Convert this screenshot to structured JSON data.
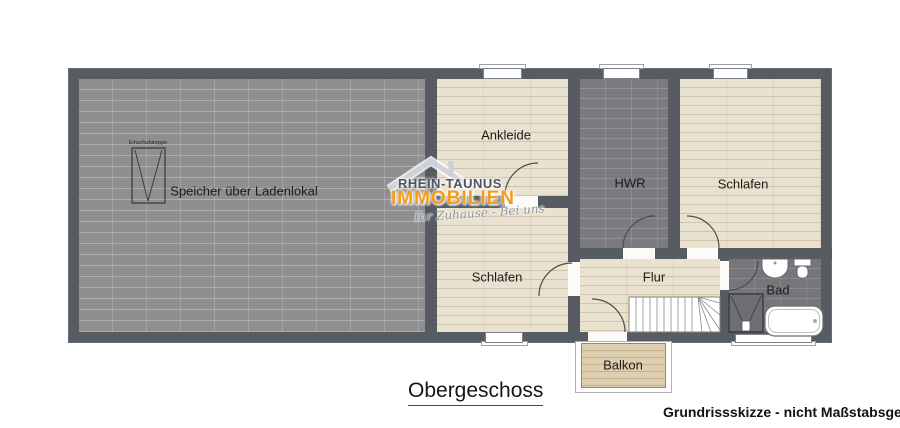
{
  "title": {
    "floor": "Obergeschoss",
    "disclaimer": "Grundrissskizze - nicht Maßstabsgetreu!"
  },
  "logo": {
    "name_top": "RHEIN-TAUNUS",
    "name_bottom": "IMMOBILIEN",
    "tagline": "Ihr Zuhause - Bei uns",
    "accent_color": "#F29B1D",
    "text_color": "#4D545C"
  },
  "rooms": {
    "speicher": {
      "label": "Speicher über Ladenlokal"
    },
    "ankleide": {
      "label": "Ankleide"
    },
    "hwr": {
      "label": "HWR"
    },
    "schlafen_top": {
      "label": "Schlafen"
    },
    "schlafen_bottom": {
      "label": "Schlafen"
    },
    "flur": {
      "label": "Flur"
    },
    "bad": {
      "label": "Bad"
    },
    "balkon": {
      "label": "Balkon"
    }
  },
  "annotations": {
    "attic_ladder": "Einschubtreppe"
  },
  "colors": {
    "wall": "#575C63",
    "wood_floor": "#EAE2D0",
    "stone_floor": "#8F8F8F",
    "tile_floor": "#7A7A7F",
    "deck": "#DECFB0"
  }
}
